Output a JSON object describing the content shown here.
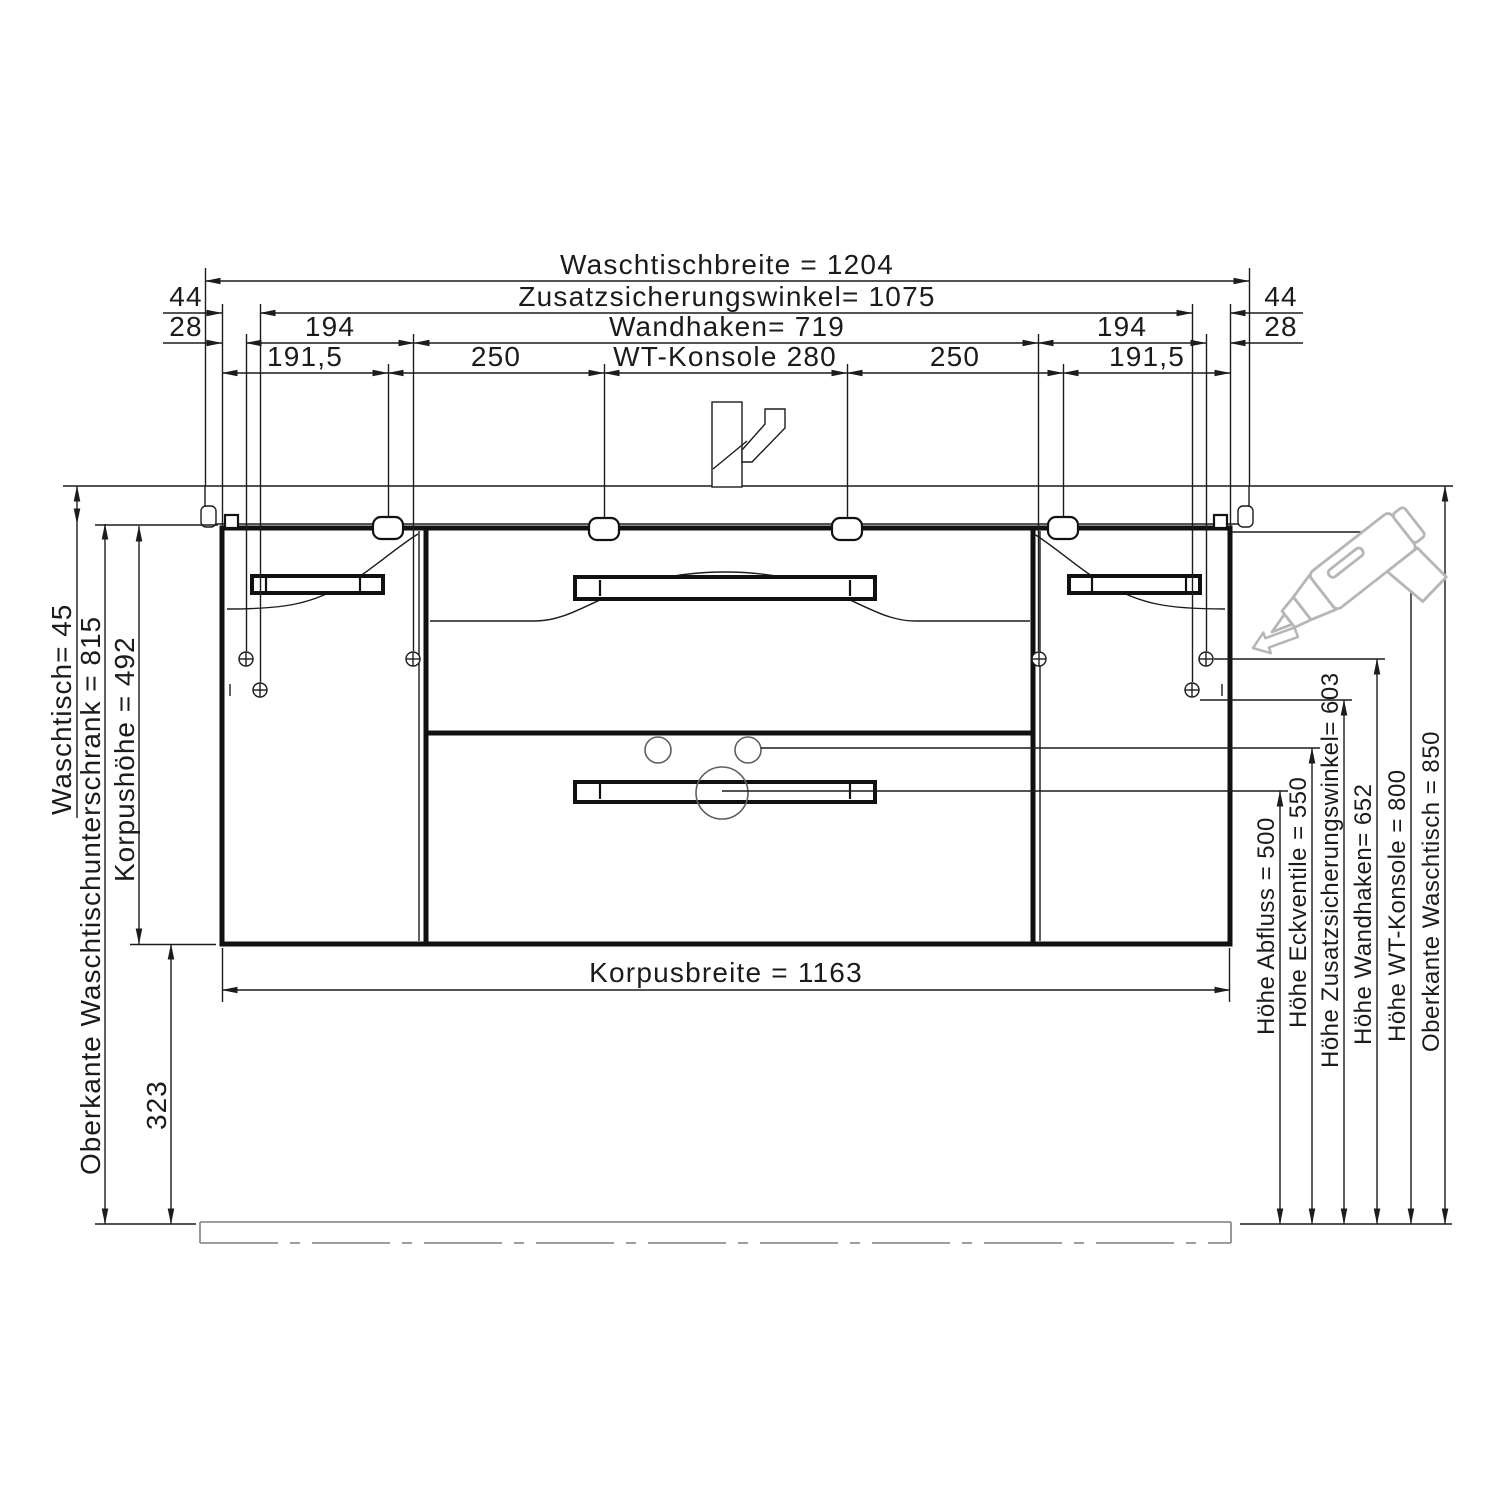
{
  "drawing": {
    "type": "furniture installation drawing, bathroom vanity front view",
    "line_color": "#1c1c1c",
    "decor_gray": "#b6b6b6",
    "top_dimensions": {
      "waschtischbreite": "Waschtischbreite = 1204",
      "zusatzsicherungswinkel": "Zusatzsicherungswinkel= 1075",
      "offset_44_left": "44",
      "offset_44_right": "44",
      "wandhaken": "Wandhaken= 719",
      "offset_28_left": "28",
      "offset_28_right": "28",
      "dist_194_left": "194",
      "dist_194_right": "194",
      "dist_191_left": "191,5",
      "dist_250_left": "250",
      "wt_konsole": "WT-Konsole 280",
      "dist_250_right": "250",
      "dist_191_right": "191,5"
    },
    "left_dimensions": {
      "waschtisch_staerke": "Waschtisch= 45",
      "oberkante_unterschrank": "Oberkante Waschtischunterschrank = 815",
      "korpushoehe": "Korpushöhe = 492",
      "abstand_unterkante": "323"
    },
    "bottom_dimensions": {
      "korpusbreite": "Korpusbreite = 1163"
    },
    "right_dimensions": {
      "hoehe_abfluss": "Höhe Abfluss = 500",
      "hoehe_eckventile": "Höhe Eckventile = 550",
      "hoehe_zusatzsicherungswinkel": "Höhe Zusatzsicherungswinkel= 603",
      "hoehe_wandhaken": "Höhe Wandhaken= 652",
      "hoehe_wt_konsole": "Höhe WT-Konsole = 800",
      "oberkante_waschtisch": "Oberkante Waschtisch = 850"
    }
  }
}
